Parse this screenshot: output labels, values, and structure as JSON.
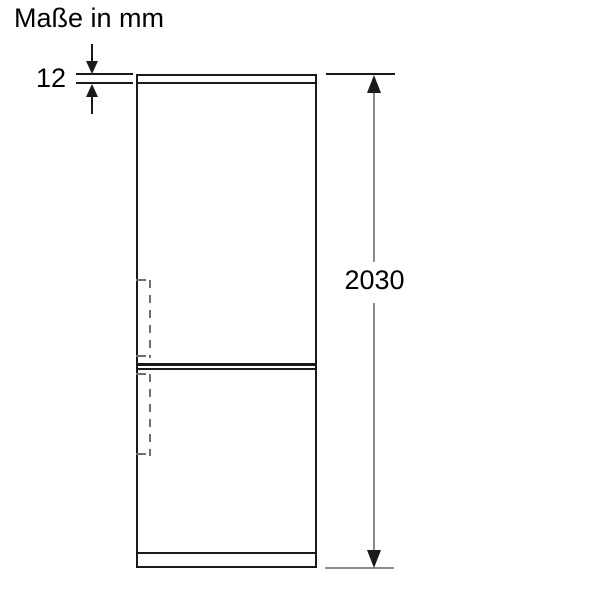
{
  "title": "Maße in mm",
  "labels": {
    "top_thickness": "12",
    "overall_height": "2030"
  },
  "dimensions": [
    {
      "name": "top_panel_thickness",
      "value": 12,
      "unit": "mm"
    },
    {
      "name": "overall_height",
      "value": 2030,
      "unit": "mm"
    }
  ],
  "colors": {
    "outline": "#1a1a1a",
    "dimension_line": "#8c8c8c",
    "dashed_line": "#707070",
    "background": "#ffffff",
    "text": "#000000"
  }
}
